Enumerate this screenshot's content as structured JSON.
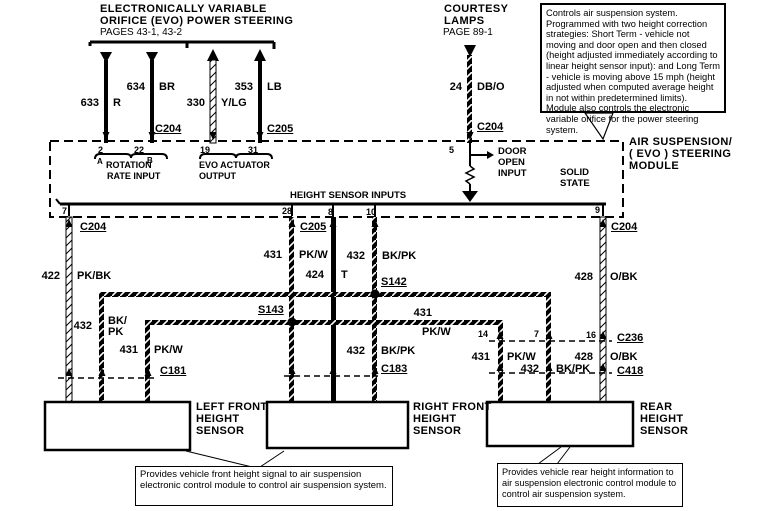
{
  "header_evo": {
    "line1": "ELECTRONICALLY  VARIABLE",
    "line2": "ORIFICE (EVO)  POWER  STEERING",
    "line3": "PAGES 43-1, 43-2"
  },
  "header_courtesy": {
    "line1": "COURTESY",
    "line2": "LAMPS",
    "line3": "PAGE 89-1"
  },
  "note_top": "Controls air suspension system. Programmed with two height correction strategies: Short Term - vehicle not moving and door open and then closed (height adjusted immediately according to linear height sensor input): and Long Term - vehicle is moving above 15 mph (height adjusted when computed average height in not within predetermined limits). Module also controls the electronic variable orifice for the power steering system.",
  "module": {
    "name1": "AIR  SUSPENSION/",
    "name2": "( EVO )  STEERING",
    "name3": "MODULE",
    "solid1": "SOLID",
    "solid2": "STATE",
    "door1": "DOOR",
    "door2": "OPEN",
    "door3": "INPUT",
    "height_inputs": "HEIGHT SENSOR INPUTS",
    "rot_a": "A",
    "rot_b": "B",
    "rotation": "ROTATION",
    "rate_input": "RATE INPUT",
    "evo_act": "EVO ACTUATOR",
    "evo_out": "OUTPUT"
  },
  "pins": {
    "p2": "2",
    "p22": "22",
    "p19": "19",
    "p31": "31",
    "p5": "5",
    "p7": "7",
    "p28": "28",
    "p8": "8",
    "p10": "10",
    "p9": "9",
    "p14": "14",
    "p7_c236": "7",
    "p16": "16"
  },
  "connectors": {
    "c204_top": "C204",
    "c205_top": "C205",
    "c204_courtesy": "C204",
    "c204_left": "C204",
    "c205_bottom": "C205",
    "c204_right": "C204",
    "c181": "C181",
    "c183": "C183",
    "c236": "C236",
    "c418": "C418"
  },
  "splices": {
    "s142": "S142",
    "s143": "S143"
  },
  "wire_labels": {
    "w633": {
      "num": "633",
      "color": "R"
    },
    "w634": {
      "num": "634",
      "color": "BR"
    },
    "w330": {
      "num": "330",
      "color": "Y/LG"
    },
    "w353": {
      "num": "353",
      "color": "LB"
    },
    "w24": {
      "num": "24",
      "color": "DB/O"
    },
    "w422": {
      "num": "422",
      "color": "PK/BK"
    },
    "w431_c205": {
      "num": "431",
      "color": "PK/W"
    },
    "w424": {
      "num": "424",
      "color": "T"
    },
    "w432_s142": {
      "num": "432",
      "color": "BK/PK"
    },
    "w428_top": {
      "num": "428",
      "color": "O/BK"
    },
    "w432_left": {
      "num": "432",
      "color": "BK/\nPK"
    },
    "w431_left": {
      "num": "431",
      "color": "PK/W"
    },
    "w431_mid": {
      "num": "431",
      "color": "PK/W"
    },
    "w432_mid": {
      "num": "432",
      "color": "BK/PK"
    },
    "w431_rear": {
      "num": "431",
      "color": "PK/W"
    },
    "w432_rear": {
      "num": "432",
      "color": "BK/PK"
    },
    "w428_rear": {
      "num": "428",
      "color": "O/BK"
    }
  },
  "sensors": {
    "left_front": [
      "LEFT  FRONT",
      "HEIGHT",
      "SENSOR"
    ],
    "right_front": [
      "RIGHT FRONT",
      "HEIGHT",
      "SENSOR"
    ],
    "rear": [
      "REAR",
      "HEIGHT",
      "SENSOR"
    ]
  },
  "note_front": "Provides vehicle front height signal to air suspension electronic control module to control air suspension system.",
  "note_rear": "Provides vehicle rear height information to air suspension electronic control module to control air suspension system.",
  "colors": {
    "ink": "#000000",
    "paper": "#ffffff"
  }
}
